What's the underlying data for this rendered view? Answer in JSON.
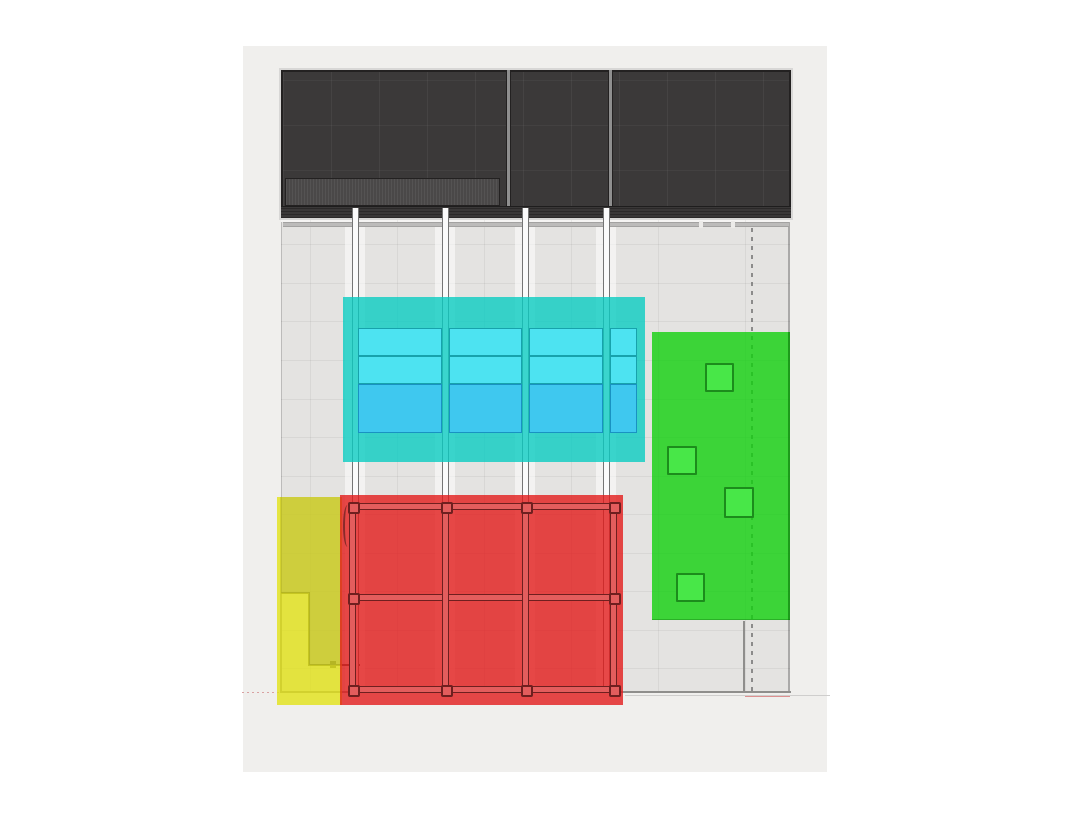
{
  "canvas": {
    "w": 1068,
    "h": 822,
    "bg": "#ffffff"
  },
  "paper": {
    "rect": [
      243,
      46,
      584,
      726
    ],
    "fill": "#f0efed"
  },
  "stage": {
    "rect": [
      281,
      70,
      510,
      148
    ],
    "fill": "#3b3939",
    "border": "#232121",
    "outline": "#d8d7d6",
    "separators_x": [
      506,
      608
    ],
    "separator_fill": "#8f8f8f",
    "substrip": {
      "rect": [
        285,
        178,
        215,
        28
      ],
      "fill": "#4a4848"
    },
    "bottom_band": {
      "rect": [
        281,
        206,
        510,
        12
      ],
      "fill_a": "#2b2929",
      "fill_b": "#3a3838"
    }
  },
  "floor": {
    "rect": [
      281,
      218,
      509,
      475
    ],
    "fill": "#e4e3e1",
    "edge_left": "#bcbbba",
    "edge_right": "#aaa9a8",
    "gap": {
      "rect": [
        281,
        218,
        509,
        4
      ],
      "fill": "#f5f4f3"
    },
    "strip": {
      "rect": [
        283,
        222,
        506,
        5
      ],
      "fill": "#bcbbba",
      "border": "#a3a2a1",
      "gaps_x": [
        699,
        731
      ],
      "gap_fill": "#ecebe9"
    },
    "v_lines": [
      310,
      397,
      484,
      571,
      658,
      745
    ],
    "h_lines": [
      244,
      283,
      321,
      360,
      399,
      437,
      476,
      514,
      553,
      591,
      630,
      668
    ],
    "line_color": "rgba(0,0,0,0.05)",
    "light_bands": {
      "centers_x": [
        355,
        445,
        525,
        606
      ],
      "w": 20,
      "y": 222,
      "h": 469,
      "fill": "rgba(255,255,255,0.55)"
    },
    "dashed_line": {
      "x": 751,
      "y": 228,
      "h": 463,
      "color": "rgba(110,110,110,0.75)"
    },
    "walls": {
      "color": "#8f8e8c",
      "step_color": "#54544a",
      "left": [
        280,
        497,
        2,
        196
      ],
      "bottom": [
        281,
        691,
        510,
        2
      ],
      "right_lower": [
        743,
        621,
        2,
        70
      ],
      "step_h1": [
        281,
        592,
        29,
        2
      ],
      "step_v": [
        308,
        592,
        2,
        74
      ],
      "step_h2": [
        308,
        664,
        52,
        2
      ],
      "step_tick": [
        330,
        661,
        6,
        7
      ]
    },
    "extra_lines": [
      {
        "rect": [
          242,
          692,
          39,
          1
        ],
        "dashed": true,
        "color": "#d9a2a2"
      },
      {
        "rect": [
          625,
          695,
          205,
          1
        ],
        "dashed": false,
        "color": "#cfcecd"
      },
      {
        "rect": [
          745,
          696,
          45,
          1
        ],
        "dashed": false,
        "color": "#dd9090"
      }
    ]
  },
  "rails": {
    "xs": [
      352,
      442,
      522,
      603
    ],
    "y": 208,
    "h": 483,
    "w": 7,
    "fill": "#fbfbfb",
    "border": "#757575"
  },
  "zones": {
    "yellow": {
      "rect": [
        277,
        497,
        65,
        208
      ],
      "fill": "rgba(226,226,22,0.8)",
      "olive_fill": "rgba(70,70,55,0.13)",
      "olive_rects": [
        [
          281,
          497,
          61,
          96
        ],
        [
          309,
          593,
          33,
          72
        ]
      ]
    },
    "red": {
      "rect": [
        340,
        495,
        283,
        210
      ],
      "fill": "rgba(226,28,28,0.8)",
      "truss": {
        "bar_fill": "#e35d5d",
        "bar_border": "#6f1f1f",
        "h_bars": [
          [
            349,
            503,
            268,
            7
          ],
          [
            349,
            594,
            268,
            7
          ],
          [
            349,
            686,
            268,
            7
          ]
        ],
        "v_bars": [
          [
            349,
            503,
            7,
            190
          ],
          [
            442,
            503,
            7,
            190
          ],
          [
            522,
            503,
            7,
            190
          ],
          [
            610,
            503,
            7,
            190
          ]
        ],
        "posts": [
          [
            348,
            502
          ],
          [
            441,
            502
          ],
          [
            521,
            502
          ],
          [
            609,
            502
          ],
          [
            348,
            593
          ],
          [
            609,
            593
          ],
          [
            348,
            685
          ],
          [
            441,
            685
          ],
          [
            521,
            685
          ],
          [
            609,
            685
          ]
        ],
        "post_size": 12,
        "arc": {
          "rect": [
            343,
            505,
            9,
            42
          ],
          "color": "#8a2a2a"
        }
      }
    },
    "cyan": {
      "rect": [
        343,
        297,
        302,
        165
      ],
      "fill": "rgba(10,204,194,0.8)",
      "cols": [
        [
          358,
          84
        ],
        [
          449,
          73
        ],
        [
          529,
          74
        ],
        [
          610,
          27
        ]
      ],
      "rows": [
        {
          "y": 328,
          "h": 28,
          "fill": "#4de3f1",
          "border": "#17a2ac"
        },
        {
          "y": 356,
          "h": 28,
          "fill": "#4de3f1",
          "border": "#17a2ac"
        },
        {
          "y": 384,
          "h": 49,
          "fill": "#3fc8ef",
          "border": "#1992c2"
        }
      ]
    },
    "green": {
      "rect": [
        652,
        332,
        138,
        288
      ],
      "fill": "rgba(18,208,14,0.8)",
      "edge_right": {
        "rect": [
          788,
          332,
          2,
          288
        ],
        "color": "rgba(9,110,9,0.5)"
      },
      "edge_bottom": {
        "rect": [
          652,
          619,
          138,
          1
        ],
        "color": "rgba(9,110,9,0.35)"
      },
      "squares": [
        [
          705,
          363,
          29,
          29
        ],
        [
          667,
          446,
          30,
          29
        ],
        [
          724,
          487,
          30,
          31
        ],
        [
          676,
          573,
          29,
          29
        ]
      ],
      "square_fill": "#48e748",
      "square_border": "#1c8c1c"
    }
  },
  "labels": {}
}
